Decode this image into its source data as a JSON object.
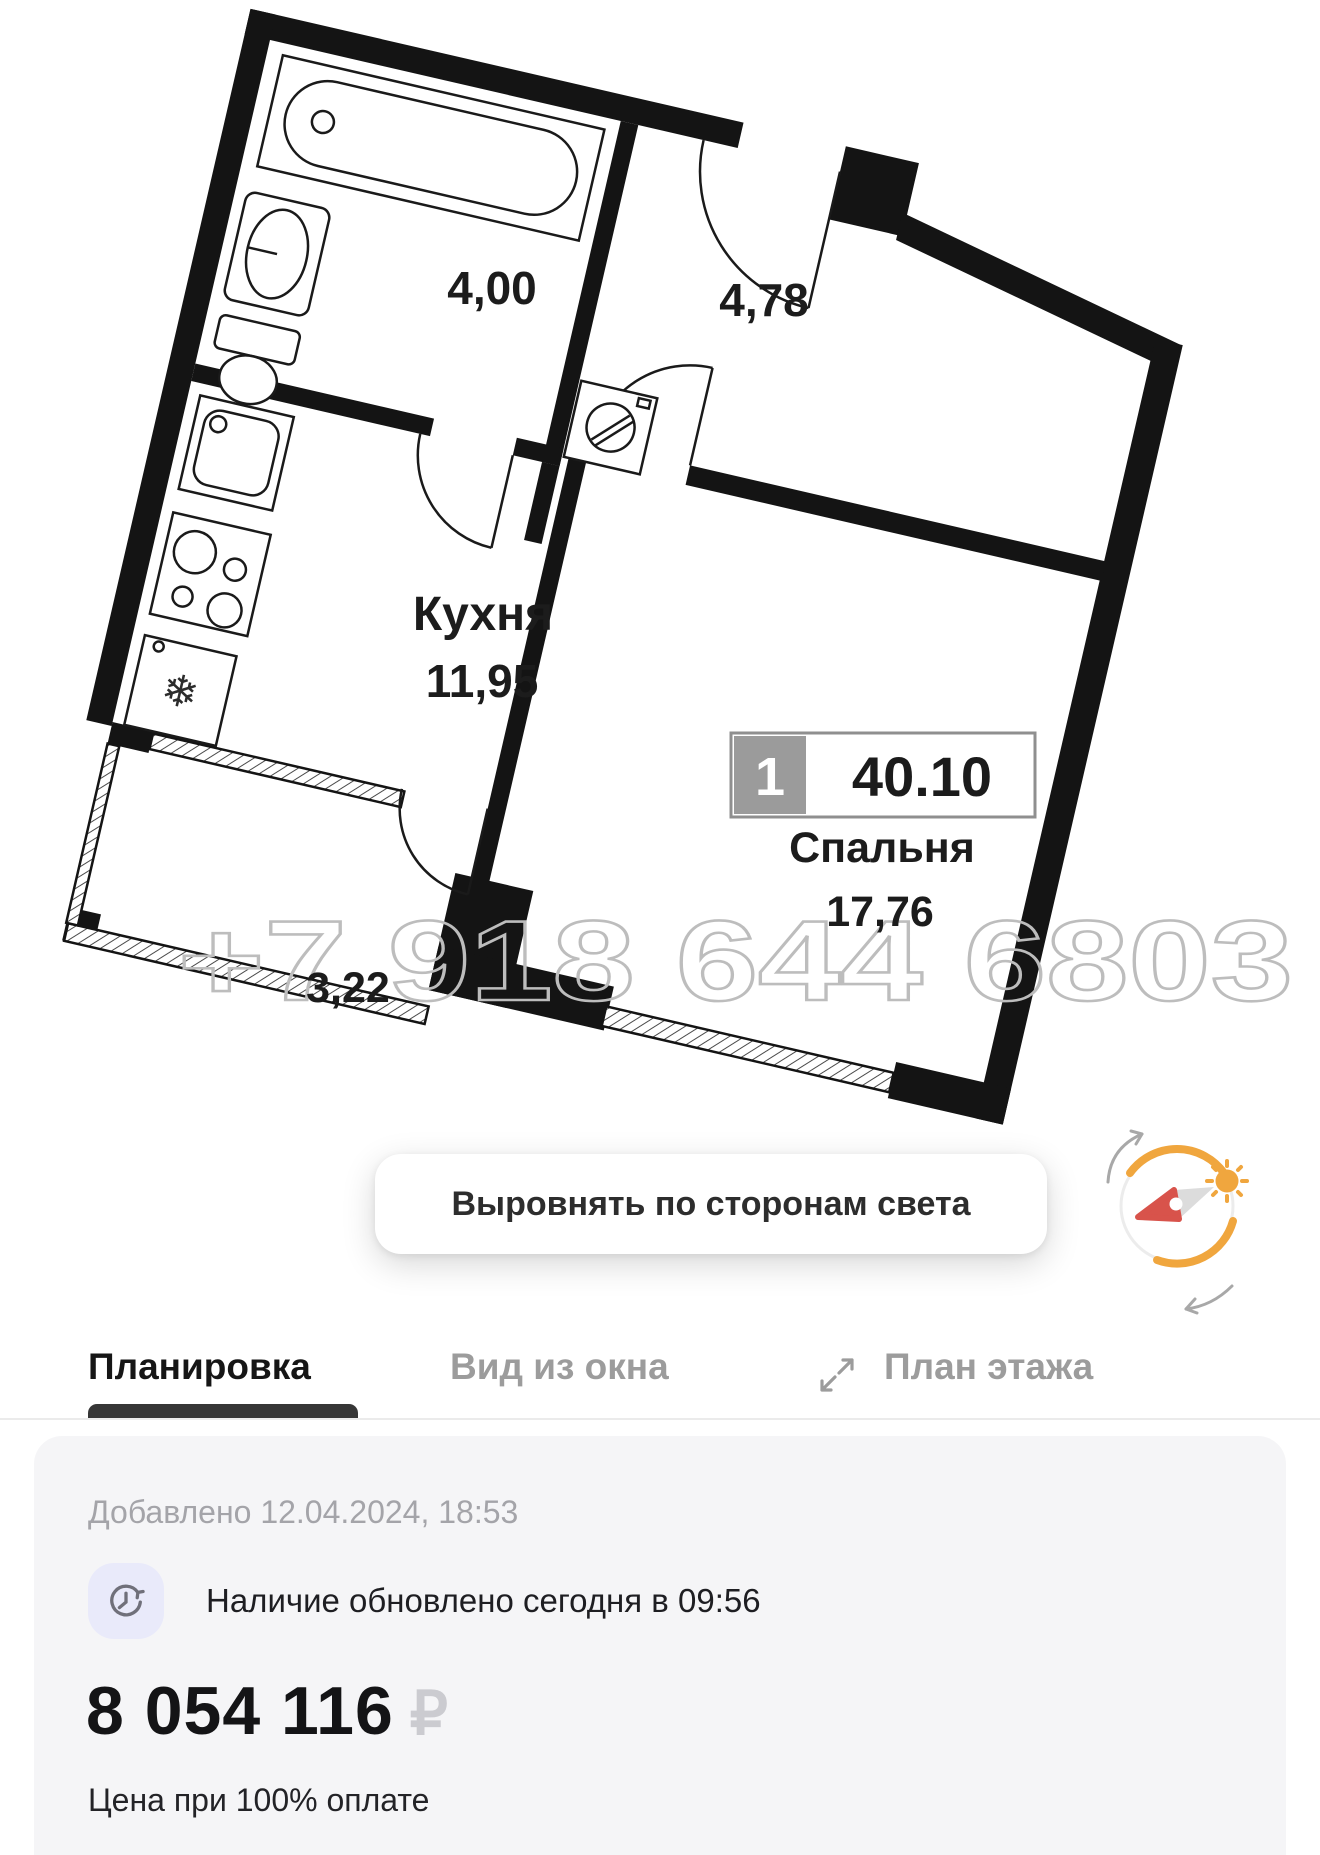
{
  "floor_plan": {
    "watermark": "+7 918 644 6803",
    "labels": {
      "bathroom_area": "4,00",
      "hall_area": "4,78",
      "kitchen_name": "Кухня",
      "kitchen_area": "11,95",
      "bedroom_name": "Спальня",
      "bedroom_area": "17,76",
      "balcony_area": "3,22"
    },
    "badge": {
      "rooms_count": "1",
      "total_area": "40.10"
    },
    "align_button": "Выровнять по сторонам света"
  },
  "tabs": [
    {
      "label": "Планировка",
      "active": true
    },
    {
      "label": "Вид из окна",
      "active": false
    },
    {
      "label": "План этажа",
      "active": false
    }
  ],
  "info": {
    "added": "Добавлено 12.04.2024, 18:53",
    "availability": "Наличие обновлено сегодня в 09:56",
    "price": "8 054 116",
    "currency": "₽",
    "price_note": "Цена при 100% оплате"
  },
  "icons": {
    "compass": "compass-sun-icon",
    "expand": "expand-icon",
    "clock": "history-clock-icon"
  },
  "colors": {
    "walls": "#141414",
    "watermark": "#BDBDBD",
    "accent_orange": "#F0A63E",
    "compass_red": "#D8534B",
    "tab_active": "#161616",
    "tab_inactive": "#9C9C9C",
    "card_bg": "#F5F5F7",
    "icon_circle_bg": "#E9EAFA",
    "price_color": "#141416",
    "ruble_color": "#CBCBD0"
  }
}
